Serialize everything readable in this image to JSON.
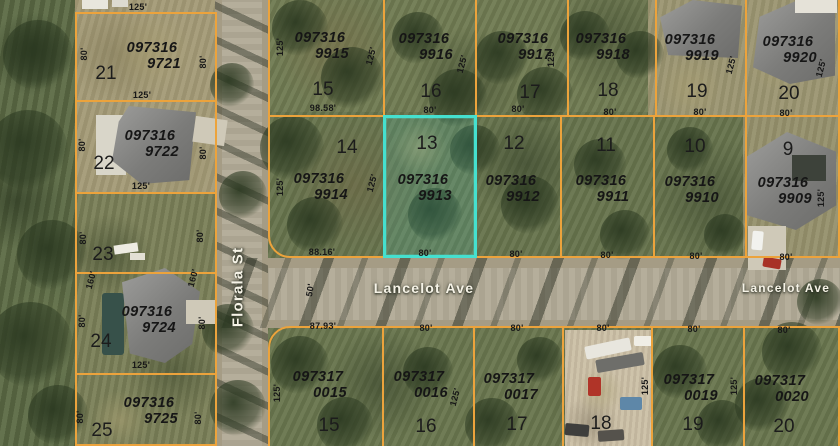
{
  "map": {
    "colors": {
      "parcel_line": "#ECA33C",
      "highlight": "#45E0CF",
      "street_label": "#F6F3E7",
      "label_text": "#161616"
    },
    "street_labels": [
      {
        "t": "Florala St",
        "x": 238,
        "y": 287,
        "r": -90,
        "size": 15
      },
      {
        "t": "Lancelot Ave",
        "x": 424,
        "y": 288,
        "r": 0,
        "size": 14
      },
      {
        "t": "Lancelot Ave",
        "x": 786,
        "y": 288,
        "r": 0,
        "size": 12
      }
    ],
    "parcels": [
      {
        "name": "21",
        "id": "097316 9721",
        "lot": "21",
        "rect": [
          75,
          12,
          140,
          88
        ],
        "id_pos": [
          152,
          57
        ],
        "lot_pos": [
          106,
          74
        ]
      },
      {
        "name": "22",
        "id": "097316 9722",
        "lot": "22",
        "rect": [
          75,
          100,
          140,
          92
        ],
        "id_pos": [
          150,
          145
        ],
        "lot_pos": [
          104,
          164
        ]
      },
      {
        "name": "23",
        "id": null,
        "lot": "23",
        "rect": [
          75,
          192,
          140,
          80
        ],
        "lot_pos": [
          103,
          255
        ]
      },
      {
        "name": "24",
        "id": "097316 9724",
        "lot": "24",
        "rect": [
          75,
          272,
          140,
          101
        ],
        "id_pos": [
          147,
          321
        ],
        "lot_pos": [
          101,
          342
        ]
      },
      {
        "name": "25",
        "id": "097316 9725",
        "lot": "25",
        "rect": [
          75,
          373,
          140,
          71
        ],
        "id_pos": [
          149,
          412
        ],
        "lot_pos": [
          102,
          431
        ]
      },
      {
        "name": "9915",
        "id": "097316 9915",
        "lot": "15",
        "rect": [
          268,
          -6,
          115,
          121
        ],
        "id_pos": [
          320,
          47
        ],
        "lot_pos": [
          323,
          90
        ]
      },
      {
        "name": "9916",
        "id": "097316 9916",
        "lot": "16",
        "rect": [
          383,
          -6,
          92,
          121
        ],
        "id_pos": [
          424,
          48
        ],
        "lot_pos": [
          431,
          92
        ]
      },
      {
        "name": "9917",
        "id": "097316 9917",
        "lot": "17",
        "rect": [
          475,
          -6,
          92,
          121
        ],
        "id_pos": [
          523,
          48
        ],
        "lot_pos": [
          530,
          93
        ]
      },
      {
        "name": "9918",
        "id": "097316 9918",
        "lot": "18",
        "rect": [
          567,
          -6,
          88,
          121
        ],
        "id_pos": [
          601,
          48
        ],
        "lot_pos": [
          608,
          91
        ]
      },
      {
        "name": "9919",
        "id": "097316 9919",
        "lot": "19",
        "rect": [
          655,
          -6,
          90,
          121
        ],
        "id_pos": [
          690,
          49
        ],
        "lot_pos": [
          697,
          92
        ]
      },
      {
        "name": "9920",
        "id": "097316 9920",
        "lot": "20",
        "rect": [
          745,
          -6,
          93,
          121
        ],
        "id_pos": [
          788,
          51
        ],
        "lot_pos": [
          789,
          94
        ]
      },
      {
        "name": "9914",
        "id": "097316 9914",
        "lot": "14",
        "rect": [
          268,
          115,
          115,
          141
        ],
        "id_pos": [
          319,
          188
        ],
        "lot_pos": [
          347,
          148
        ],
        "radius": "0 0 0 22px"
      },
      {
        "name": "9913",
        "id": "097316 9913",
        "lot": "13",
        "rect": [
          383,
          115,
          92,
          141
        ],
        "id_pos": [
          423,
          189
        ],
        "lot_pos": [
          427,
          144
        ],
        "highlight": true
      },
      {
        "name": "9912",
        "id": "097316 9912",
        "lot": "12",
        "rect": [
          475,
          115,
          85,
          141
        ],
        "id_pos": [
          511,
          190
        ],
        "lot_pos": [
          514,
          144
        ]
      },
      {
        "name": "9911",
        "id": "097316 9911",
        "lot": "11",
        "rect": [
          560,
          115,
          93,
          141
        ],
        "id_pos": [
          601,
          190
        ],
        "lot_pos": [
          606,
          146
        ]
      },
      {
        "name": "9910",
        "id": "097316 9910",
        "lot": "10",
        "rect": [
          653,
          115,
          92,
          141
        ],
        "id_pos": [
          690,
          191
        ],
        "lot_pos": [
          695,
          147
        ]
      },
      {
        "name": "9909",
        "id": "097316 9909",
        "lot": "9",
        "rect": [
          745,
          115,
          93,
          141
        ],
        "id_pos": [
          783,
          192
        ],
        "lot_pos": [
          788,
          150
        ]
      },
      {
        "name": "0015",
        "id": "097317 0015",
        "lot": "15",
        "rect": [
          268,
          326,
          114,
          122
        ],
        "id_pos": [
          318,
          386
        ],
        "lot_pos": [
          329,
          426
        ],
        "radius": "22px 0 0 0"
      },
      {
        "name": "0016",
        "id": "097317 0016",
        "lot": "16",
        "rect": [
          382,
          326,
          91,
          122
        ],
        "id_pos": [
          419,
          386
        ],
        "lot_pos": [
          426,
          427
        ]
      },
      {
        "name": "0017",
        "id": "097317 0017",
        "lot": "17",
        "rect": [
          473,
          326,
          89,
          122
        ],
        "id_pos": [
          509,
          388
        ],
        "lot_pos": [
          517,
          425
        ]
      },
      {
        "name": "18-south",
        "id": null,
        "lot": "18",
        "rect": [
          562,
          326,
          89,
          122
        ],
        "lot_pos": [
          601,
          424
        ]
      },
      {
        "name": "0019",
        "id": "097317 0019",
        "lot": "19",
        "rect": [
          651,
          326,
          92,
          122
        ],
        "id_pos": [
          689,
          389
        ],
        "lot_pos": [
          693,
          425
        ]
      },
      {
        "name": "0020",
        "id": "097317 0020",
        "lot": "20",
        "rect": [
          743,
          326,
          95,
          122
        ],
        "id_pos": [
          780,
          390
        ],
        "lot_pos": [
          784,
          427
        ]
      }
    ],
    "dims": [
      {
        "t": "125'",
        "x": 138,
        "y": 7,
        "r": 0
      },
      {
        "t": "80'",
        "x": 84,
        "y": 54,
        "r": -90
      },
      {
        "t": "80'",
        "x": 203,
        "y": 62,
        "r": -90
      },
      {
        "t": "125'",
        "x": 142,
        "y": 95,
        "r": 0
      },
      {
        "t": "80'",
        "x": 82,
        "y": 145,
        "r": -90
      },
      {
        "t": "80'",
        "x": 203,
        "y": 153,
        "r": -90
      },
      {
        "t": "125'",
        "x": 141,
        "y": 186,
        "r": 0
      },
      {
        "t": "80'",
        "x": 83,
        "y": 238,
        "r": -90
      },
      {
        "t": "80'",
        "x": 200,
        "y": 236,
        "r": -90
      },
      {
        "t": "160'",
        "x": 91,
        "y": 280,
        "r": -75
      },
      {
        "t": "160'",
        "x": 193,
        "y": 278,
        "r": -75
      },
      {
        "t": "80'",
        "x": 82,
        "y": 321,
        "r": -90
      },
      {
        "t": "80'",
        "x": 202,
        "y": 323,
        "r": -90
      },
      {
        "t": "125'",
        "x": 141,
        "y": 365,
        "r": 0
      },
      {
        "t": "80'",
        "x": 80,
        "y": 417,
        "r": -90
      },
      {
        "t": "80'",
        "x": 198,
        "y": 418,
        "r": -90
      },
      {
        "t": "125'",
        "x": 280,
        "y": 47,
        "r": -90
      },
      {
        "t": "98.58'",
        "x": 323,
        "y": 108,
        "r": 0
      },
      {
        "t": "125'",
        "x": 371,
        "y": 56,
        "r": -75
      },
      {
        "t": "80'",
        "x": 430,
        "y": 110,
        "r": 0
      },
      {
        "t": "125'",
        "x": 462,
        "y": 64,
        "r": -75
      },
      {
        "t": "80'",
        "x": 518,
        "y": 109,
        "r": 0
      },
      {
        "t": "125'",
        "x": 551,
        "y": 58,
        "r": -90
      },
      {
        "t": "80'",
        "x": 610,
        "y": 112,
        "r": 0
      },
      {
        "t": "80'",
        "x": 700,
        "y": 112,
        "r": 0
      },
      {
        "t": "125'",
        "x": 731,
        "y": 65,
        "r": -75
      },
      {
        "t": "80'",
        "x": 786,
        "y": 113,
        "r": 0
      },
      {
        "t": "125'",
        "x": 821,
        "y": 68,
        "r": -75
      },
      {
        "t": "125'",
        "x": 280,
        "y": 187,
        "r": -90
      },
      {
        "t": "88.16'",
        "x": 322,
        "y": 252,
        "r": 0
      },
      {
        "t": "125'",
        "x": 372,
        "y": 183,
        "r": -75
      },
      {
        "t": "80'",
        "x": 425,
        "y": 253,
        "r": 0
      },
      {
        "t": "80'",
        "x": 516,
        "y": 254,
        "r": 0
      },
      {
        "t": "80'",
        "x": 607,
        "y": 255,
        "r": 0
      },
      {
        "t": "80'",
        "x": 696,
        "y": 256,
        "r": 0
      },
      {
        "t": "80'",
        "x": 786,
        "y": 257,
        "r": 0
      },
      {
        "t": "125'",
        "x": 821,
        "y": 198,
        "r": -90
      },
      {
        "t": "50'",
        "x": 310,
        "y": 290,
        "r": -80
      },
      {
        "t": "87.93'",
        "x": 323,
        "y": 326,
        "r": 0
      },
      {
        "t": "80'",
        "x": 426,
        "y": 328,
        "r": 0
      },
      {
        "t": "125'",
        "x": 277,
        "y": 393,
        "r": -90
      },
      {
        "t": "125'",
        "x": 455,
        "y": 397,
        "r": -75
      },
      {
        "t": "80'",
        "x": 517,
        "y": 328,
        "r": 0
      },
      {
        "t": "80'",
        "x": 603,
        "y": 328,
        "r": 0
      },
      {
        "t": "125'",
        "x": 645,
        "y": 386,
        "r": -90
      },
      {
        "t": "80'",
        "x": 694,
        "y": 329,
        "r": 0
      },
      {
        "t": "125'",
        "x": 734,
        "y": 386,
        "r": -90
      },
      {
        "t": "80'",
        "x": 784,
        "y": 330,
        "r": 0
      }
    ]
  }
}
